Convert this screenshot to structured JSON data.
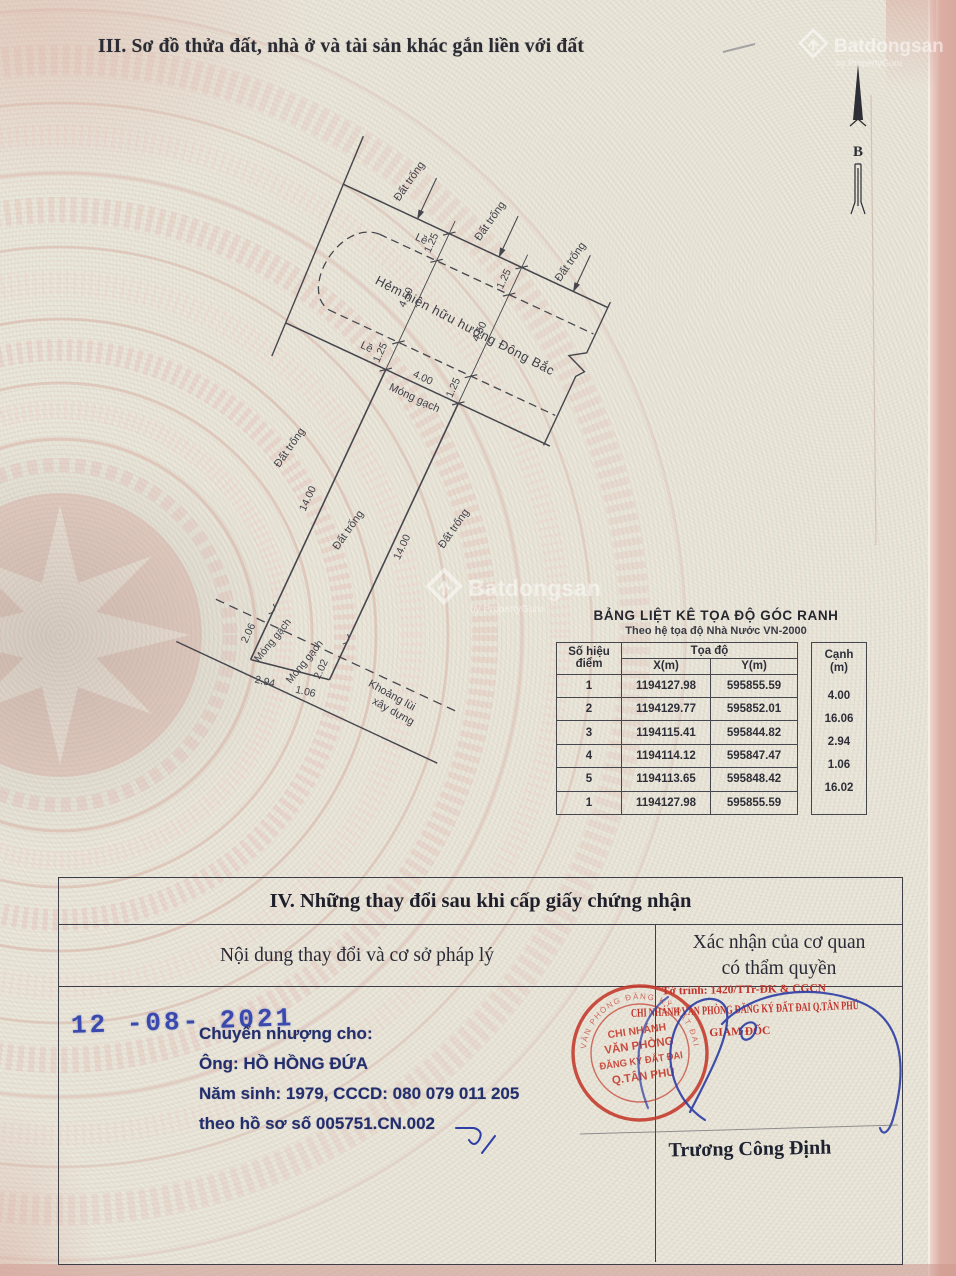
{
  "page": {
    "title": "III. Sơ đồ thửa đất, nhà ở và tài sản khác gắn liền với đất"
  },
  "watermark": {
    "brand": "Batdongsan",
    "subtitle": "by PropertyGuru"
  },
  "compass": {
    "north_label": "B"
  },
  "diagram": {
    "labels": {
      "le": "Lề",
      "dat_trong": "Đất trống",
      "hem": "Hẻm hiện hữu hướng Đông Bắc",
      "mong_gach": "Móng gạch",
      "khoang_lui_1": "Khoảng lùi",
      "khoang_lui_2": "xây dựng"
    },
    "dims": {
      "d125": "1.25",
      "d450": "4.50",
      "d400": "4.00",
      "d1400": "14.00",
      "d206": "2.06",
      "d202": "2.02",
      "d294": "2.94",
      "d106": "1.06"
    }
  },
  "coord_table": {
    "title": "BẢNG LIỆT KÊ TỌA ĐỘ GÓC RANH",
    "subtitle": "Theo hệ tọa độ Nhà Nước VN-2000",
    "point_header_1": "Số hiệu",
    "point_header_2": "điểm",
    "coord_header": "Tọa độ",
    "x_header": "X(m)",
    "y_header": "Y(m)",
    "edge_header_1": "Cạnh",
    "edge_header_2": "(m)",
    "rows": [
      {
        "id": "1",
        "x": "1194127.98",
        "y": "595855.59"
      },
      {
        "id": "2",
        "x": "1194129.77",
        "y": "595852.01"
      },
      {
        "id": "3",
        "x": "1194115.41",
        "y": "595844.82"
      },
      {
        "id": "4",
        "x": "1194114.12",
        "y": "595847.47"
      },
      {
        "id": "5",
        "x": "1194113.65",
        "y": "595848.42"
      },
      {
        "id": "1",
        "x": "1194127.98",
        "y": "595855.59"
      }
    ],
    "edges": [
      "4.00",
      "16.06",
      "2.94",
      "1.06",
      "16.02"
    ]
  },
  "section4": {
    "title": "IV. Những thay đổi sau khi cấp giấy chứng nhận",
    "left_header": "Nội dung thay đổi và cơ sở pháp lý",
    "right_header_1": "Xác nhận của cơ quan",
    "right_header_2": "có thẩm quyền",
    "date_stamp": "12 -08- 2021",
    "content_lines": [
      "Chuyển nhượng cho:",
      "Ông:  HỒ HỒNG ĐỨA",
      "Năm sinh: 1979,   CCCD: 080 079 011 205",
      "theo hồ sơ số  005751.CN.002"
    ],
    "approval": {
      "line1": "Tờ trình: 1420/TTr-ĐK & CGCN",
      "line2": "CHI NHÁNH VĂN PHÒNG ĐĂNG KÝ ĐẤT ĐAI Q.TÂN PHÚ",
      "line3": "GIÁM ĐỐC",
      "signer": "Trương Công Định"
    },
    "stamp": {
      "ring": "VĂN PHÒNG ĐĂNG KÝ ĐẤT ĐAI",
      "l1": "CHI NHÁNH",
      "l2": "VĂN PHÒNG",
      "l3": "ĐĂNG KÝ ĐẤT ĐAI",
      "l4": "Q.TÂN PHÚ"
    }
  }
}
